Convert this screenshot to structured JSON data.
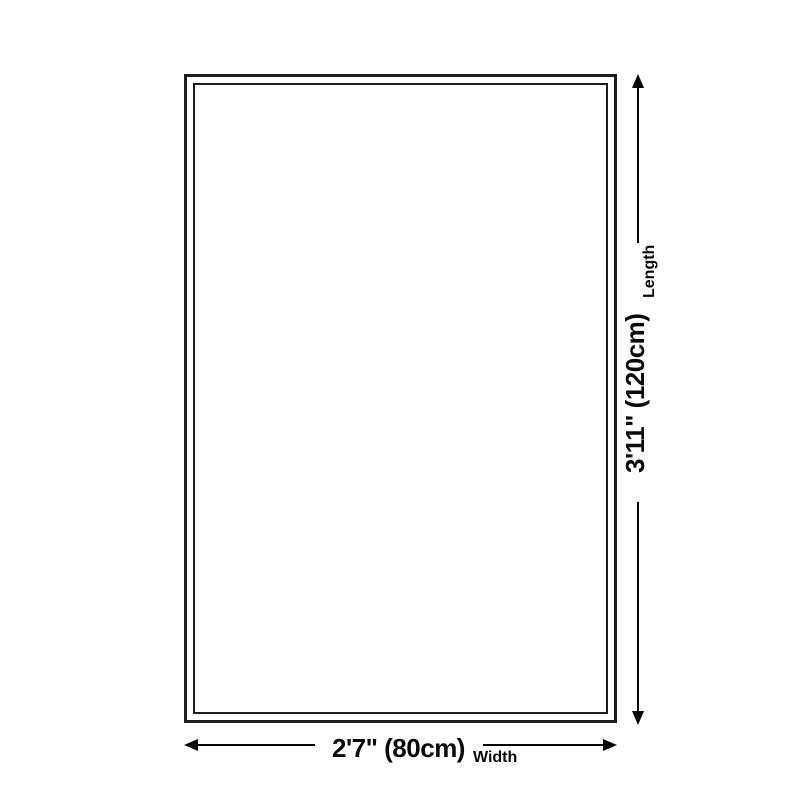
{
  "diagram": {
    "type": "product-size-diagram",
    "shape": "rectangle-with-double-border",
    "length": {
      "value": "3'11\" (120cm)",
      "label": "Length"
    },
    "width": {
      "value": "2'7\" (80cm)",
      "label": "Width"
    },
    "colors": {
      "background": "#ffffff",
      "outline": "#1e1e1e",
      "arrow": "#050505",
      "text": "#0a0a0a"
    }
  }
}
